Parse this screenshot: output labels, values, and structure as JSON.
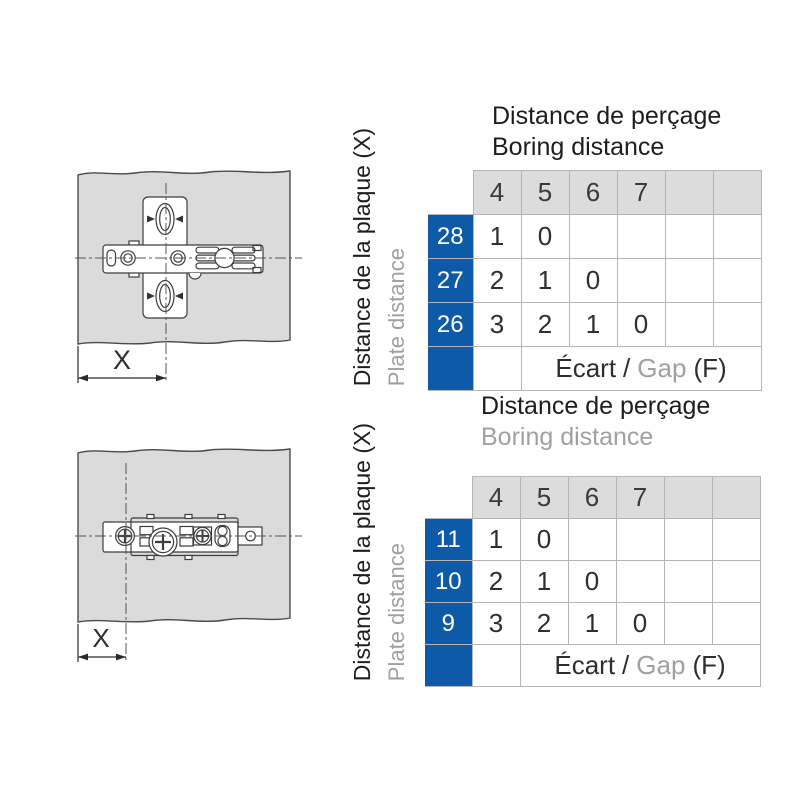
{
  "colors": {
    "accent_blue": "#0d5ba8",
    "header_gray": "#dcdcdc",
    "grid_line": "#b5b5b5",
    "text_dark": "#1d1d1f",
    "text_gray": "#a0a0a0",
    "panel_fill": "#dbdbdb"
  },
  "sections": [
    {
      "side_label": {
        "primary": "Distance de la plaque (X)",
        "secondary": "Plate distance"
      },
      "drawing": {
        "dimension_label": "X"
      },
      "table": {
        "title_primary": "Distance de perçage",
        "title_secondary": "Boring distance",
        "column_headers": [
          "4",
          "5",
          "6",
          "7",
          "",
          ""
        ],
        "rows": [
          {
            "header": "28",
            "values": [
              "1",
              "0",
              "",
              "",
              "",
              ""
            ]
          },
          {
            "header": "27",
            "values": [
              "2",
              "1",
              "0",
              "",
              "",
              ""
            ]
          },
          {
            "header": "26",
            "values": [
              "3",
              "2",
              "1",
              "0",
              "",
              ""
            ]
          }
        ],
        "footer": {
          "label_fr": "Écart",
          "separator": "/",
          "label_en": "Gap",
          "suffix": "(F)"
        }
      }
    },
    {
      "side_label": {
        "primary": "Distance de la plaque (X)",
        "secondary": "Plate distance"
      },
      "drawing": {
        "dimension_label": "X"
      },
      "table": {
        "title_primary": "Distance de perçage",
        "title_secondary": "Boring distance",
        "column_headers": [
          "4",
          "5",
          "6",
          "7",
          "",
          ""
        ],
        "rows": [
          {
            "header": "11",
            "values": [
              "1",
              "0",
              "",
              "",
              "",
              ""
            ]
          },
          {
            "header": "10",
            "values": [
              "2",
              "1",
              "0",
              "",
              "",
              ""
            ]
          },
          {
            "header": "9",
            "values": [
              "3",
              "2",
              "1",
              "0",
              "",
              ""
            ]
          }
        ],
        "footer": {
          "label_fr": "Écart",
          "separator": "/",
          "label_en": "Gap",
          "suffix": "(F)"
        }
      }
    }
  ]
}
